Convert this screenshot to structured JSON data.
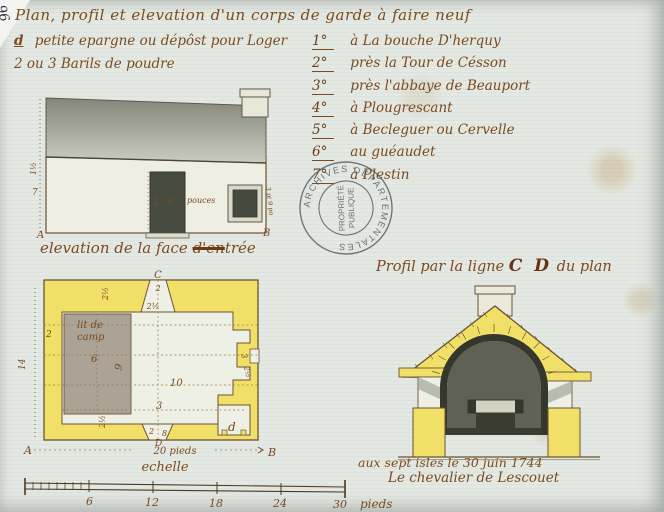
{
  "document": {
    "archival_mark": "96",
    "header": {
      "title": "Plan, profil et elevation d'un corps de garde à faire neuf",
      "note_prefix": "d",
      "note_line1": "petite epargne ou dépôst pour Loger",
      "note_line2": "2 ou 3 Barils de poudre"
    },
    "locations": [
      {
        "num": "1°",
        "name": "à La bouche D'herquy"
      },
      {
        "num": "2°",
        "name": "près la Tour de Césson"
      },
      {
        "num": "3°",
        "name": "près l'abbaye de Beauport"
      },
      {
        "num": "4°",
        "name": "à Plougrescant"
      },
      {
        "num": "5°",
        "name": "à Becleguer ou Cervelle"
      },
      {
        "num": "6°",
        "name": "au guéaudet"
      },
      {
        "num": "7°",
        "name": "à Plestin"
      }
    ],
    "stamp": {
      "ring": "ARCHIVES DÉPARTEMENTALES",
      "center1": "PROPRIÉTÉ",
      "center2": "PUBLIQUE"
    },
    "elevation": {
      "caption_prefix": "elevation de la face ",
      "caption_struck": "d'en",
      "caption_suffix": "trée",
      "labels": {
        "roof_h": "1½",
        "wall_h": "7",
        "door": "2 - 8",
        "door_unit": "pouces",
        "window": "3 pi 9 po",
        "a": "A",
        "b": "B"
      }
    },
    "plan": {
      "labels": {
        "c": "C",
        "d": "D",
        "d_small": "d",
        "a": "A",
        "b": "B",
        "bed1": "lit de",
        "bed2": "camp",
        "bed_w": "6",
        "bed_l": "9",
        "room_l": "10",
        "left_w": "2",
        "depth": "14",
        "top_door": "2",
        "top_splay": "2½",
        "top_wall": "2½",
        "bottom_mid": "3",
        "bottom_door_a": "2",
        "bottom_door_b": "8",
        "bottom_wall": "2½",
        "win_a": "3",
        "win_b": "2½",
        "width_line": "20 pieds",
        "scale_caption": "echelle"
      }
    },
    "profile": {
      "title_prefix": "Profil par la ligne ",
      "title_cd": "C D",
      "title_suffix": " du plan"
    },
    "footer": {
      "dateline": "aux sept isles le 30 juin 1744",
      "signature": "Le chevalier de Lescouet"
    },
    "scalebar": {
      "t6": "6",
      "t12": "12",
      "t18": "18",
      "t24": "24",
      "t30": "30",
      "unit": "pieds"
    }
  }
}
